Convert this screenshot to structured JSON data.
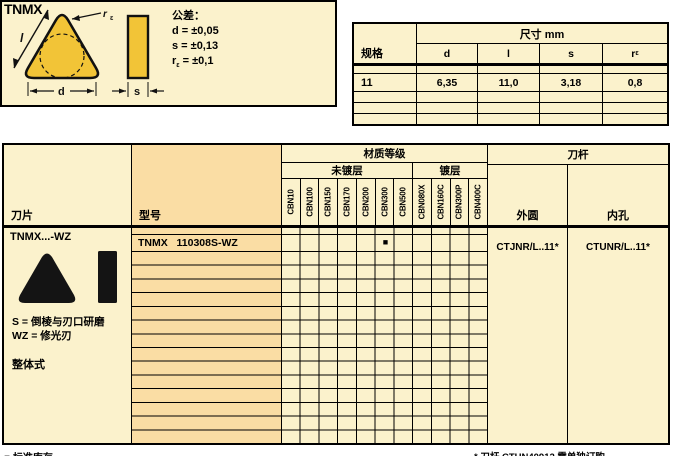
{
  "page": {
    "title": "TNMX"
  },
  "colors": {
    "cream_bg": "#FBF2CC",
    "peach_bg": "#FADDA4",
    "insert_yellow": "#F2C437",
    "line": "#000000"
  },
  "tolerance_box": {
    "title": "公差：",
    "line_d": "d = ±0,05",
    "line_s": "s = ±0,13",
    "re_line": {
      "base": "r",
      "sub": "ε",
      "rest": " = ±0,1"
    },
    "diagram": {
      "l": "l",
      "d": "d",
      "s": "s",
      "re_base": "r",
      "re_sub": "ε"
    }
  },
  "dimensions_table": {
    "title": "尺寸 mm",
    "spec_header": "规格",
    "col_d": "d",
    "col_l": "l",
    "col_s": "s",
    "col_re": {
      "base": "r",
      "sub": "ε"
    },
    "row": {
      "spec": "11",
      "d": "6,35",
      "l": "11,0",
      "s": "3,18",
      "re": "0,8"
    }
  },
  "main_table": {
    "insert_header": "刀片",
    "model_header": "型号",
    "grade_group_header": "材质等级",
    "uncoated_header": "未镀层",
    "coated_header": "镀层",
    "holder_group_header": "刀杆",
    "external_header": "外圆",
    "internal_header": "内孔",
    "grade_columns": [
      "CBN10",
      "CBN100",
      "CBN150",
      "CBN170",
      "CBN200",
      "CBN300",
      "CBN500",
      "CBN080X",
      "CBN160C",
      "CBN300P",
      "CBN400C"
    ],
    "insert_info": {
      "family": "TNMX...-WZ",
      "note_s": "S = 倒棱与刃口研磨",
      "note_wz": "WZ = 修光刃",
      "type": "整体式"
    },
    "row": {
      "model": "TNMX   110308S-WZ",
      "marked_grade": "CBN300",
      "mark_symbol": "■",
      "external_holder": "CTJNR/L..11*",
      "internal_holder": "CTUNR/L..11*"
    }
  },
  "footnotes": {
    "stock_legend": "■ 标准库存",
    "holder_note": "* 刀杆 CTUN40912  需单独订购"
  }
}
